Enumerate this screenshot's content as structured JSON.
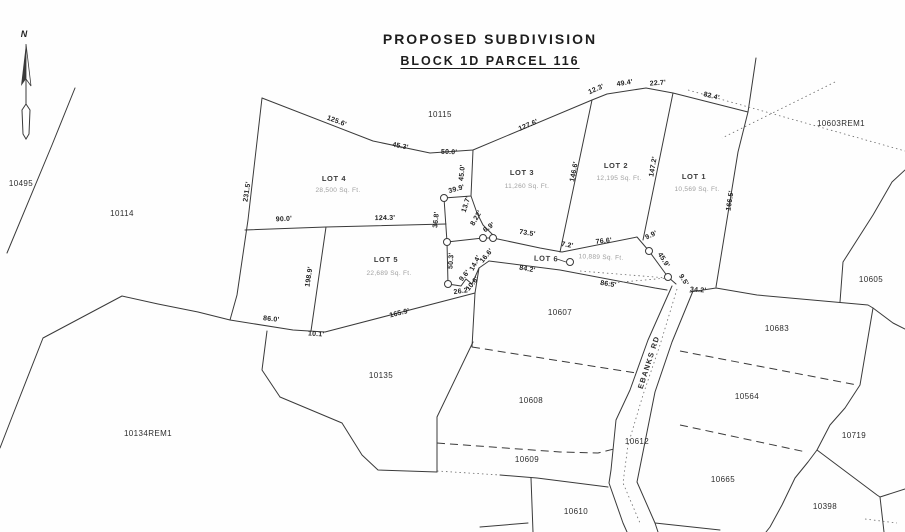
{
  "title": {
    "line1": "PROPOSED SUBDIVISION",
    "line2": "BLOCK 1D PARCEL 116"
  },
  "north_label": "N",
  "road": {
    "label": "EBANKS RD"
  },
  "lots": [
    {
      "name": "LOT 1",
      "area": "10,569 Sq. Ft.",
      "x": 694,
      "y": 179,
      "ax": 697,
      "ay": 191,
      "r": 0
    },
    {
      "name": "LOT 2",
      "area": "12,195 Sq. Ft.",
      "x": 616,
      "y": 168,
      "ax": 619,
      "ay": 180,
      "r": 0
    },
    {
      "name": "LOT 3",
      "area": "11,260 Sq. Ft.",
      "x": 522,
      "y": 175,
      "ax": 527,
      "ay": 188,
      "r": 0
    },
    {
      "name": "LOT 4",
      "area": "28,500 Sq. Ft.",
      "x": 334,
      "y": 181,
      "ax": 338,
      "ay": 192,
      "r": 0
    },
    {
      "name": "LOT 5",
      "area": "22,689 Sq. Ft.",
      "x": 386,
      "y": 262,
      "ax": 389,
      "ay": 275,
      "r": 0
    },
    {
      "name": "LOT 6",
      "area": "10,889 Sq. Ft.",
      "x": 546,
      "y": 261,
      "ax": 601,
      "ay": 259,
      "r": 2
    }
  ],
  "parcels": [
    {
      "id": "10115",
      "x": 440,
      "y": 117
    },
    {
      "id": "10603REM1",
      "x": 841,
      "y": 126
    },
    {
      "id": "10495",
      "x": 21,
      "y": 186
    },
    {
      "id": "10114",
      "x": 122,
      "y": 216
    },
    {
      "id": "10134REM1",
      "x": 148,
      "y": 436
    },
    {
      "id": "10135",
      "x": 381,
      "y": 378
    },
    {
      "id": "10607",
      "x": 560,
      "y": 315
    },
    {
      "id": "10608",
      "x": 531,
      "y": 403
    },
    {
      "id": "10609",
      "x": 527,
      "y": 462
    },
    {
      "id": "10610",
      "x": 576,
      "y": 514
    },
    {
      "id": "10612",
      "x": 637,
      "y": 444
    },
    {
      "id": "10605",
      "x": 871,
      "y": 282
    },
    {
      "id": "10683",
      "x": 777,
      "y": 331
    },
    {
      "id": "10564",
      "x": 747,
      "y": 399
    },
    {
      "id": "10719",
      "x": 854,
      "y": 438
    },
    {
      "id": "10665",
      "x": 723,
      "y": 482
    },
    {
      "id": "10398",
      "x": 825,
      "y": 509
    }
  ],
  "dimensions": [
    {
      "t": "125.6'",
      "x": 336,
      "y": 123,
      "r": 21
    },
    {
      "t": "45.3'",
      "x": 400,
      "y": 148,
      "r": 11
    },
    {
      "t": "50.0'",
      "x": 449,
      "y": 154,
      "r": 2
    },
    {
      "t": "127.6'",
      "x": 529,
      "y": 127,
      "r": -23
    },
    {
      "t": "12.3'",
      "x": 597,
      "y": 91,
      "r": -24
    },
    {
      "t": "49.4'",
      "x": 625,
      "y": 85,
      "r": -9
    },
    {
      "t": "22.7'",
      "x": 658,
      "y": 85,
      "r": -4
    },
    {
      "t": "82.4'",
      "x": 711,
      "y": 98,
      "r": 14
    },
    {
      "t": "166.5'",
      "x": 732,
      "y": 201,
      "r": -81
    },
    {
      "t": "147.2'",
      "x": 655,
      "y": 167,
      "r": -80
    },
    {
      "t": "146.6'",
      "x": 576,
      "y": 172,
      "r": -79
    },
    {
      "t": "45.0'",
      "x": 464,
      "y": 173,
      "r": -84
    },
    {
      "t": "39.9'",
      "x": 457,
      "y": 191,
      "r": -15
    },
    {
      "t": "36.8'",
      "x": 438,
      "y": 220,
      "r": -84
    },
    {
      "t": "13.7'",
      "x": 468,
      "y": 205,
      "r": -72
    },
    {
      "t": "8.22'",
      "x": 478,
      "y": 219,
      "r": -60
    },
    {
      "t": "6.9'",
      "x": 490,
      "y": 229,
      "r": -35
    },
    {
      "t": "73.5'",
      "x": 527,
      "y": 235,
      "r": 9
    },
    {
      "t": "7.2'",
      "x": 567,
      "y": 247,
      "r": 9
    },
    {
      "t": "76.6'",
      "x": 604,
      "y": 243,
      "r": -6
    },
    {
      "t": "9.9'",
      "x": 652,
      "y": 237,
      "r": -25
    },
    {
      "t": "45.9'",
      "x": 662,
      "y": 261,
      "r": 58
    },
    {
      "t": "9.5'",
      "x": 682,
      "y": 281,
      "r": 58
    },
    {
      "t": "50.3'",
      "x": 453,
      "y": 261,
      "r": -86
    },
    {
      "t": "26.2'",
      "x": 462,
      "y": 293,
      "r": -8
    },
    {
      "t": "9.6'",
      "x": 466,
      "y": 277,
      "r": -50
    },
    {
      "t": "10.6'",
      "x": 474,
      "y": 285,
      "r": -50
    },
    {
      "t": "14.4'",
      "x": 477,
      "y": 264,
      "r": -62
    },
    {
      "t": "16.6'",
      "x": 488,
      "y": 257,
      "r": -50
    },
    {
      "t": "124.3'",
      "x": 385,
      "y": 220,
      "r": -1
    },
    {
      "t": "198.9'",
      "x": 311,
      "y": 277,
      "r": -81
    },
    {
      "t": "231.5'",
      "x": 249,
      "y": 192,
      "r": -81
    },
    {
      "t": "90.0'",
      "x": 284,
      "y": 221,
      "r": -3
    },
    {
      "t": "165.9'",
      "x": 400,
      "y": 315,
      "r": -14
    },
    {
      "t": "86.0'",
      "x": 271,
      "y": 321,
      "r": 6
    },
    {
      "t": "10.1'",
      "x": 316,
      "y": 336,
      "r": 4
    },
    {
      "t": "84.2'",
      "x": 527,
      "y": 271,
      "r": 10
    },
    {
      "t": "86.5'",
      "x": 608,
      "y": 286,
      "r": 9
    },
    {
      "t": "34.2'",
      "x": 698,
      "y": 292,
      "r": 4
    }
  ]
}
